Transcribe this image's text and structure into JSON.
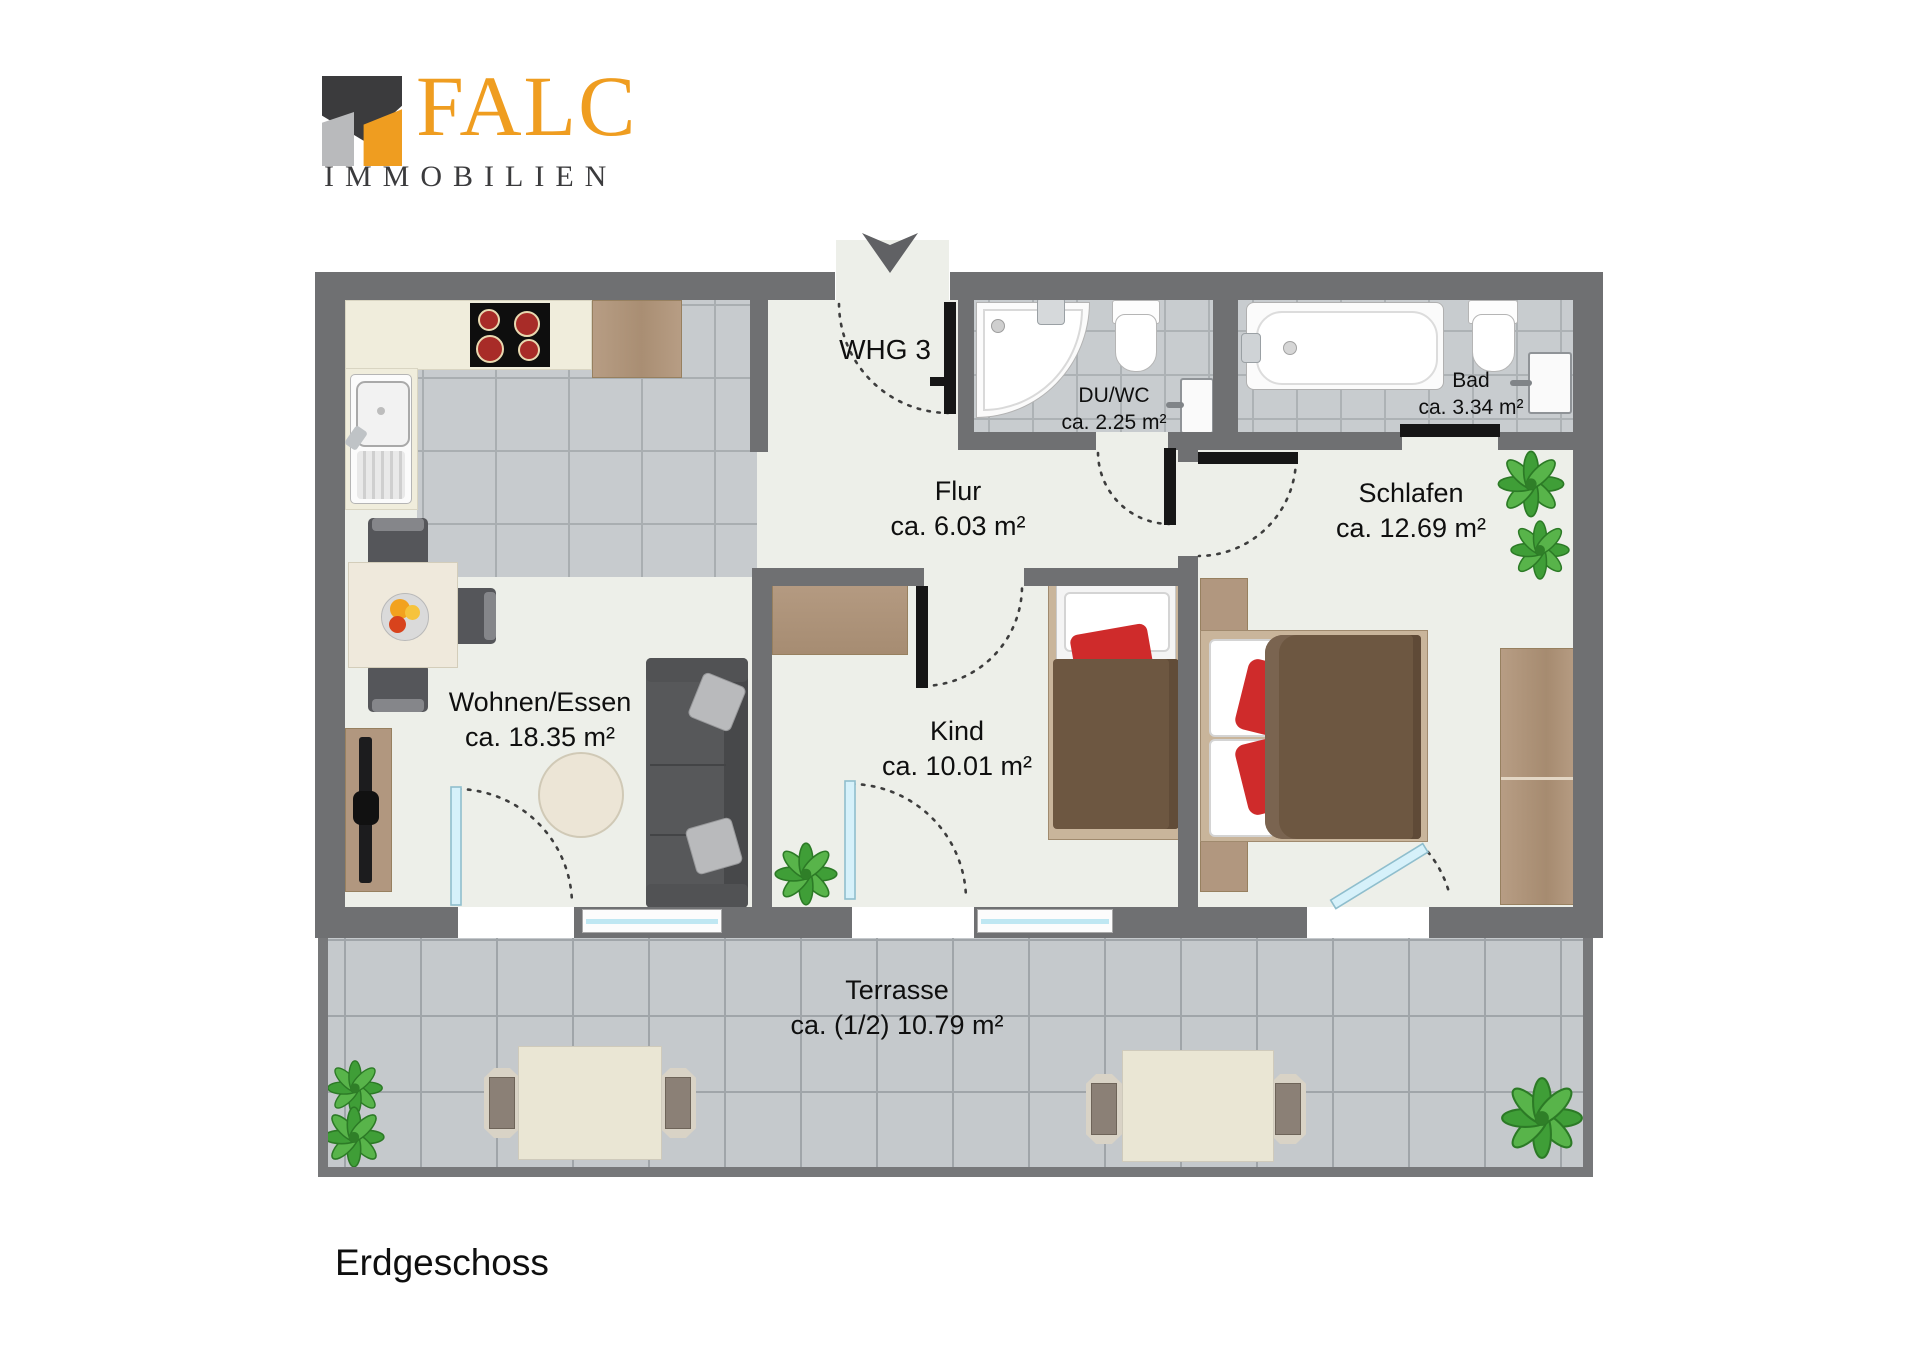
{
  "logo": {
    "brand": "FALC",
    "subtitle": "IMMOBILIEN"
  },
  "plan": {
    "unit_label": "WHG 3",
    "floor_label": "Erdgeschoss",
    "rooms": [
      {
        "name": "Flur",
        "area": "ca. 6.03 m²"
      },
      {
        "name": "DU/WC",
        "area": "ca. 2.25 m²"
      },
      {
        "name": "Bad",
        "area": "ca. 3.34 m²"
      },
      {
        "name": "Schlafen",
        "area": "ca. 12.69 m²"
      },
      {
        "name": "Kind",
        "area": "ca. 10.01 m²"
      },
      {
        "name": "Wohnen/Essen",
        "area": "ca. 18.35 m²"
      },
      {
        "name": "Terrasse",
        "area": "ca. (1/2) 10.79 m²"
      }
    ],
    "icons": {
      "entrance_arrow": "down-arrow entrance marker",
      "plant": "potted plant (top view)"
    },
    "colors": {
      "brand_orange": "#ef9d20",
      "brand_dark": "#3b3b3d",
      "brand_gray": "#b9babc",
      "wall": "#6f7072",
      "room_floor": "#edefe9",
      "tile": "#c7cbce",
      "furniture_wood": "#b1977f",
      "sofa_gray": "#55565a",
      "blanket_brown": "#6d5741",
      "cushion_red": "#cf2b2b",
      "plant_green": "#3f9e37",
      "glass_blue": "#bfe7f2"
    }
  }
}
